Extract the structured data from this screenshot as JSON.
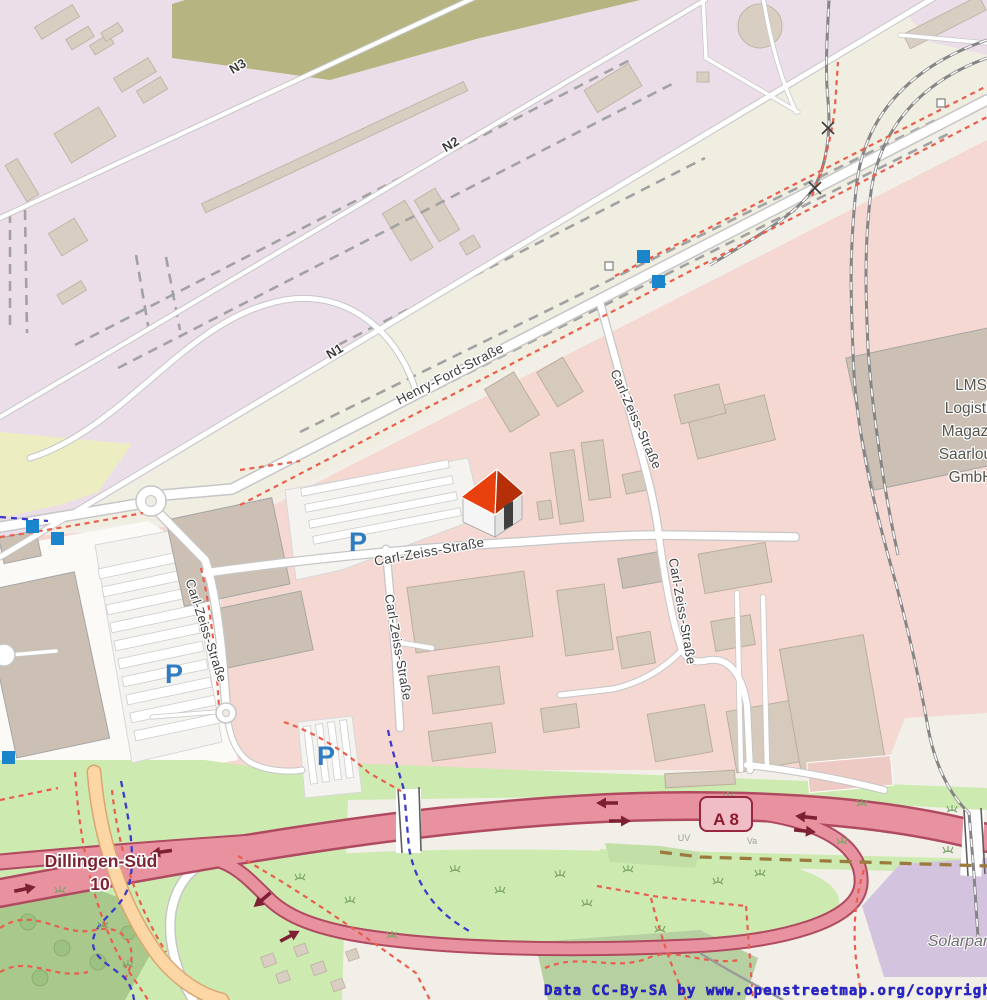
{
  "map": {
    "labels": {
      "n1": "N1",
      "n2": "N2",
      "n3": "N3",
      "henry_ford_strasse": "Henry-Ford-Straße",
      "carl_zeiss_strasse": "Carl-Zeiss-Straße",
      "motorway_ref": "A 8",
      "exit_name": "Dillingen-Süd",
      "exit_ref": "10",
      "company_lines": [
        "LMS",
        "Logistik",
        "Magazin",
        "Saarlouis",
        "GmbH"
      ],
      "solarpark": "Solarpark",
      "plot_uv": "UV",
      "plot_va": "Va",
      "parking": "P",
      "attribution": "Data CC-By-SA by www.openstreetmap.org/copyright"
    },
    "colors": {
      "industrial_area": "#ecdee9",
      "commercial_area": "#f4d8d1",
      "background": "#f2efe9",
      "grass": "#cdebb0",
      "scrub_olive": "#b6b582",
      "solar_park": "#d4c3df",
      "motorway_fill": "#e892a0",
      "motorway_casing": "#b04a60",
      "primary_road_fill": "#fcd6a4",
      "marker_blue": "#1b85cb",
      "parking_blue": "#2f7cc0",
      "route_blue": "#3a3acb",
      "footpath_red": "#ea5e4d",
      "exit_label_red": "#7c2433",
      "attribution_blue": "#2525d2",
      "house_roof_red": "#e8410e"
    },
    "markers": {
      "house_marker": "poi-house",
      "blue_square_count": 5,
      "parking_icon_count": 3,
      "railway_crossing_count": 2
    }
  }
}
